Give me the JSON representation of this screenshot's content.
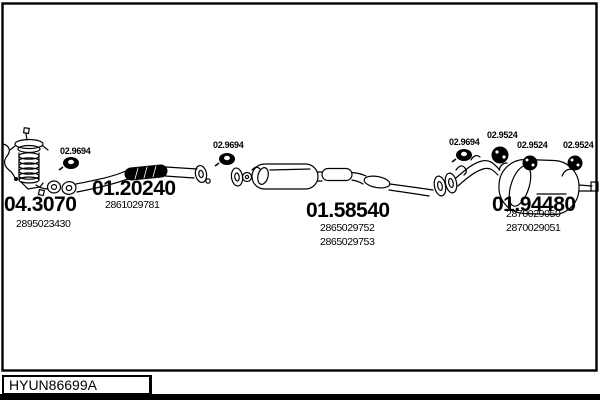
{
  "page": {
    "ink": "#000000",
    "paper": "#ffffff"
  },
  "title_block": {
    "drawing_number": "HYUN86699A"
  },
  "parts": {
    "catalytic_converter": {
      "code": "04.3070",
      "oe": [
        "2895023430"
      ]
    },
    "front_pipe": {
      "code": "01.20240",
      "oe": [
        "2861029781"
      ]
    },
    "centre_silencer": {
      "code": "01.58540",
      "oe": [
        "2865029752",
        "2865029753"
      ]
    },
    "rear_silencer": {
      "code": "01.94480",
      "oe": [
        "2870029050",
        "2870029051"
      ]
    }
  },
  "fittings": {
    "gasket_labels": [
      "02.9694",
      "02.9694",
      "02.9694"
    ],
    "hanger_labels": [
      "02.9524",
      "02.9524",
      "02.9524"
    ]
  }
}
